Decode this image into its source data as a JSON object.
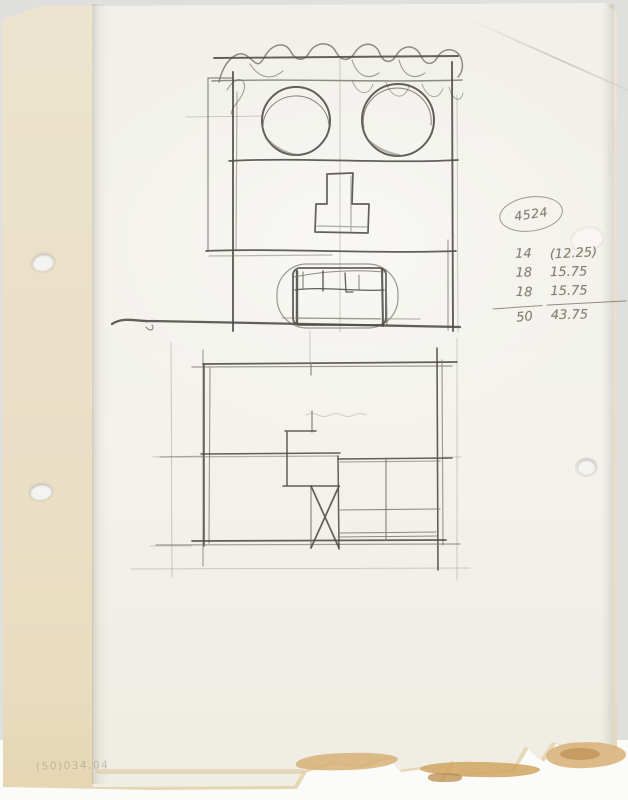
{
  "sheet": {
    "kind": "Scanned pencil sketch on hole-punched tracing paper over a cream backing sheet",
    "drawings": {
      "top": "Building front elevation resembling a face: two round windows as eyes, cross-shaped window as nose, arched doorway with mullions as mouth, scribbled foliage along the roofline, ground line below",
      "bottom": "Rough floor plan with interior partitions, X-marked stair bay, gridded area at lower right, construction lines extending past the outline"
    },
    "circled_number": "4524",
    "tally": {
      "rows": [
        {
          "qty": "14",
          "amount": "(12.25)"
        },
        {
          "qty": "18",
          "amount": "15.75"
        },
        {
          "qty": "18",
          "amount": "15.75"
        }
      ],
      "qty_total": "50",
      "amount_total": "43.75"
    },
    "stamp": "(50)034.04",
    "colors": {
      "scan_background": "#dfe0de",
      "backing_sheet": "#ebe2cb",
      "top_sheet": "#f2f1eb",
      "graphite_dark": "#514f48",
      "graphite_light": "#9b998f",
      "handwriting": "#877f6d",
      "edge_stain": "#cfa360"
    }
  }
}
